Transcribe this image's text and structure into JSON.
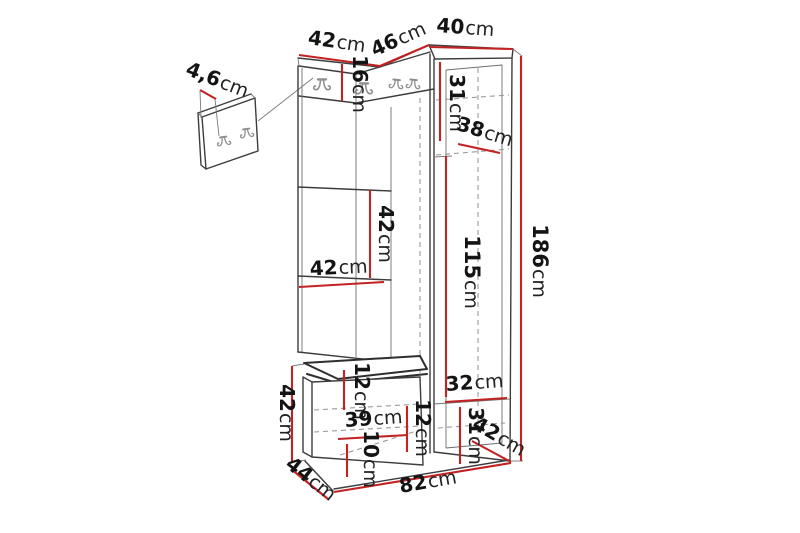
{
  "diagram": {
    "kind": "hallway-furniture-dimension-drawing",
    "unit": "cm",
    "colors": {
      "background": "#ffffff",
      "outline": "#3d3d3d",
      "hidden_edge": "#9a9a9a",
      "dimension_line": "#c32222",
      "label_text": "#141414",
      "hook": "#8f8f8f"
    },
    "labels": {
      "panel_thickness": {
        "value": "4,6",
        "unit": "cm"
      },
      "top_left_width": {
        "value": "42",
        "unit": "cm"
      },
      "top_middle_width": {
        "value": "46",
        "unit": "cm"
      },
      "top_right_width": {
        "value": "40",
        "unit": "cm"
      },
      "hook_band_height": {
        "value": "16",
        "unit": "cm"
      },
      "cabinet_upper_height": {
        "value": "31",
        "unit": "cm"
      },
      "cabinet_top_depth": {
        "value": "38",
        "unit": "cm"
      },
      "shelf_gap_height": {
        "value": "42",
        "unit": "cm"
      },
      "shelf_width": {
        "value": "42",
        "unit": "cm"
      },
      "cabinet_door_height": {
        "value": "115",
        "unit": "cm"
      },
      "total_height": {
        "value": "186",
        "unit": "cm"
      },
      "bench_height": {
        "value": "42",
        "unit": "cm"
      },
      "seat_thickness": {
        "value": "12",
        "unit": "cm"
      },
      "bench_inner_width": {
        "value": "39",
        "unit": "cm"
      },
      "bench_side_width": {
        "value": "12",
        "unit": "cm"
      },
      "bench_base_height": {
        "value": "10",
        "unit": "cm"
      },
      "cabinet_lower_width": {
        "value": "32",
        "unit": "cm"
      },
      "cabinet_lower_height": {
        "value": "31",
        "unit": "cm"
      },
      "cabinet_bottom_depth": {
        "value": "42",
        "unit": "cm"
      },
      "bench_depth": {
        "value": "44",
        "unit": "cm"
      },
      "total_width": {
        "value": "82",
        "unit": "cm"
      }
    }
  }
}
